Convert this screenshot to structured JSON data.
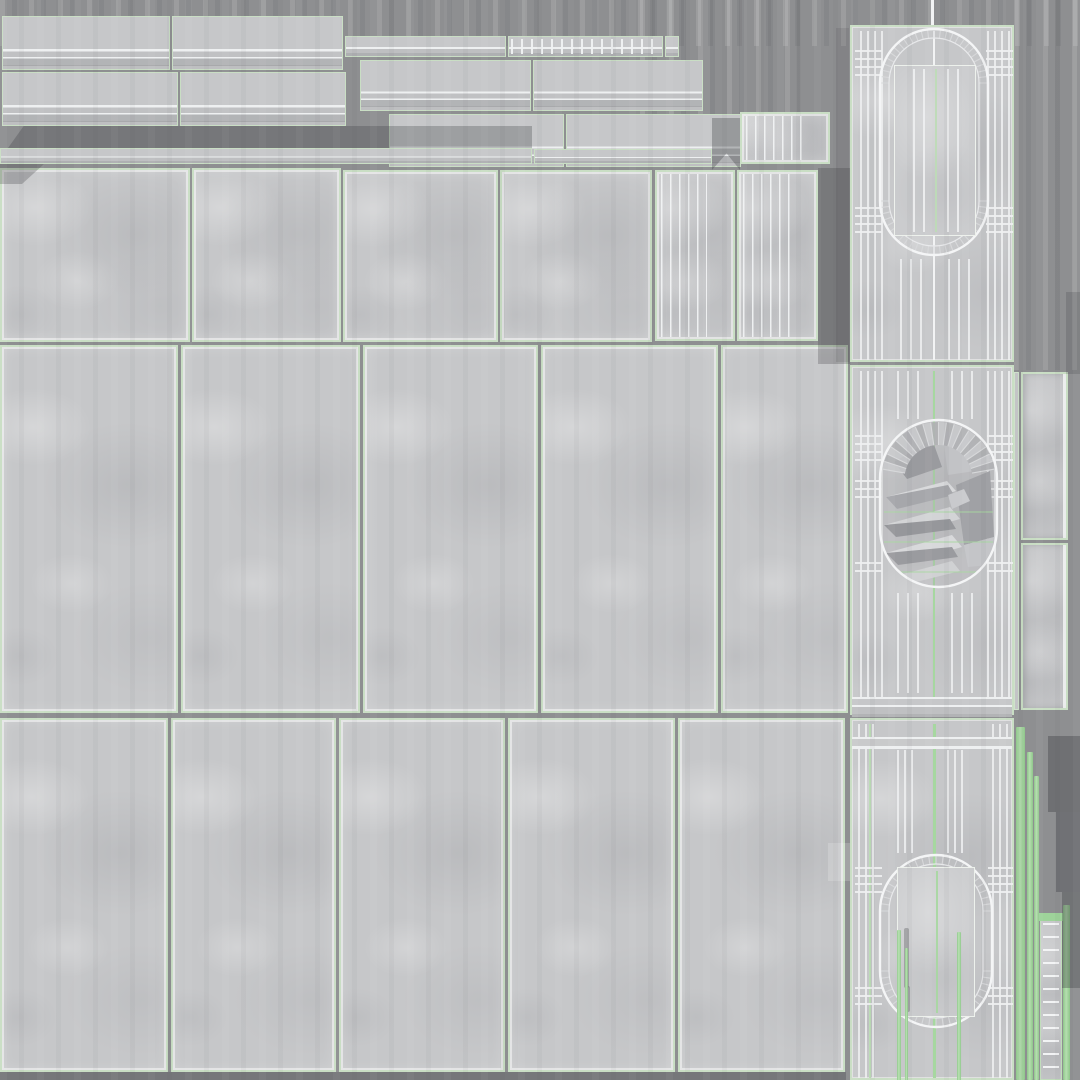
{
  "meta": {
    "description": "Texture atlas (UV sheet) for a concrete wall-panel 3D asset: baseboard molding strips, plain concrete tiles, fluted pilaster panels, three arched-niche panels, and bright green UV seam highlight stripes on a gray background.",
    "canvas": {
      "width": 1080,
      "height": 1080
    },
    "regions": [
      {
        "label": "molding-strips",
        "count": 8
      },
      {
        "label": "thin-cap-strips",
        "count": 5
      },
      {
        "label": "upper-tile-row",
        "count": 4
      },
      {
        "label": "fluted-pilaster-panels",
        "count": 3
      },
      {
        "label": "main-tile-grid-row-2",
        "count": 5
      },
      {
        "label": "main-tile-grid-row-3",
        "count": 5
      },
      {
        "label": "arched-niche-panels",
        "count": 3
      },
      {
        "label": "side-strips",
        "count": 3
      },
      {
        "label": "seam-highlight-stripes",
        "count": 4
      },
      {
        "label": "ladder-strip",
        "count": 1
      }
    ]
  },
  "palette": {
    "background": "#8e8f91",
    "concrete": "#c6c7c9",
    "concrete_light": "#d4d5d7",
    "concrete_dark": "#b6b7ba",
    "seam": "#c9dec4",
    "seam_light": "#e4efe0",
    "line": "#eef0f1",
    "line_soft": "#dcdee0",
    "green": "#a6d7a0",
    "green_soft": "#bcdcb6",
    "shadow": "#404246"
  },
  "atlas": {
    "streaks": [
      {
        "x": 0,
        "y": 0,
        "w": 1080,
        "h": 46
      },
      {
        "x": 640,
        "y": 0,
        "w": 160,
        "h": 125
      },
      {
        "x": 1014,
        "y": 0,
        "w": 66,
        "h": 370
      }
    ],
    "moldings": [
      {
        "x": 2,
        "y": 16,
        "w": 168,
        "h": 54
      },
      {
        "x": 172,
        "y": 16,
        "w": 171,
        "h": 54
      },
      {
        "x": 360,
        "y": 60,
        "w": 171,
        "h": 51
      },
      {
        "x": 533,
        "y": 60,
        "w": 170,
        "h": 51
      },
      {
        "x": 2,
        "y": 72,
        "w": 176,
        "h": 54
      },
      {
        "x": 180,
        "y": 72,
        "w": 166,
        "h": 54
      },
      {
        "x": 389,
        "y": 114,
        "w": 175,
        "h": 53
      },
      {
        "x": 566,
        "y": 114,
        "w": 175,
        "h": 53
      }
    ],
    "thins": [
      {
        "x": 345,
        "y": 36,
        "w": 161,
        "h": 21
      },
      {
        "x": 508,
        "y": 36,
        "w": 155,
        "h": 21,
        "ticks": true
      },
      {
        "x": 665,
        "y": 36,
        "w": 14,
        "h": 21
      },
      {
        "x": 0,
        "y": 148,
        "w": 532,
        "h": 16
      },
      {
        "x": 534,
        "y": 149,
        "w": 178,
        "h": 15
      }
    ],
    "tilesRow1": [
      {
        "x": 0,
        "y": 168,
        "w": 190,
        "h": 174
      },
      {
        "x": 192,
        "y": 168,
        "w": 149,
        "h": 174
      },
      {
        "x": 343,
        "y": 170,
        "w": 155,
        "h": 172
      },
      {
        "x": 500,
        "y": 170,
        "w": 152,
        "h": 172
      }
    ],
    "fluted": [
      {
        "x": 740,
        "y": 112,
        "w": 90,
        "h": 52,
        "fw": "70%"
      },
      {
        "x": 655,
        "y": 170,
        "w": 80,
        "h": 171,
        "fw": "60%"
      },
      {
        "x": 737,
        "y": 170,
        "w": 81,
        "h": 171,
        "fw": "68%"
      }
    ],
    "gridRow2": [
      {
        "x": 0,
        "y": 345,
        "w": 178,
        "h": 368
      },
      {
        "x": 181,
        "y": 345,
        "w": 179,
        "h": 368
      },
      {
        "x": 363,
        "y": 345,
        "w": 175,
        "h": 368
      },
      {
        "x": 541,
        "y": 345,
        "w": 177,
        "h": 368
      },
      {
        "x": 721,
        "y": 345,
        "w": 127,
        "h": 368
      }
    ],
    "gridRow3": [
      {
        "x": 0,
        "y": 718,
        "w": 168,
        "h": 354
      },
      {
        "x": 171,
        "y": 718,
        "w": 165,
        "h": 354
      },
      {
        "x": 339,
        "y": 718,
        "w": 166,
        "h": 354
      },
      {
        "x": 508,
        "y": 718,
        "w": 167,
        "h": 354
      },
      {
        "x": 678,
        "y": 718,
        "w": 167,
        "h": 354
      }
    ],
    "sideStrips": [
      {
        "x": 1021,
        "y": 372,
        "w": 47,
        "h": 168
      },
      {
        "x": 1021,
        "y": 543,
        "w": 47,
        "h": 167
      }
    ],
    "slivers": [
      {
        "x": 1014,
        "y": 372,
        "w": 5,
        "h": 338
      }
    ],
    "greenStripes": [
      {
        "x": 1016,
        "y": 727,
        "w": 9,
        "h": 353
      },
      {
        "x": 1027,
        "y": 752,
        "w": 6,
        "h": 328
      },
      {
        "x": 1034,
        "y": 776,
        "w": 5,
        "h": 304
      },
      {
        "x": 1063,
        "y": 905,
        "w": 7,
        "h": 175
      }
    ],
    "ladder": {
      "x": 1040,
      "y": 920,
      "w": 22,
      "h": 160
    },
    "whites": [
      {
        "x": 931,
        "y": 0,
        "w": 3,
        "h": 26
      }
    ],
    "lightPatches": [
      {
        "x": 828,
        "y": 843,
        "w": 22,
        "h": 38
      }
    ],
    "shadows": [
      {
        "x": 8,
        "y": 126,
        "w": 524,
        "h": 22,
        "a": 0.3,
        "clip": "polygon(3% 0,100% 0,100% 100%,0 100%)"
      },
      {
        "x": 0,
        "y": 164,
        "w": 44,
        "h": 20,
        "a": 0.28,
        "clip": "polygon(0 0,100% 0,50% 100%,0 100%)"
      },
      {
        "x": 712,
        "y": 118,
        "w": 28,
        "h": 52,
        "a": 0.34,
        "clip": "polygon(0 0,100% 0,100% 100%,52% 68%,0 100%)"
      },
      {
        "x": 818,
        "y": 168,
        "w": 32,
        "h": 196,
        "a": 0.28
      },
      {
        "x": 836,
        "y": 28,
        "w": 13,
        "h": 334,
        "a": 0.14
      },
      {
        "x": 0,
        "y": 1072,
        "w": 846,
        "h": 8,
        "a": 0.3
      },
      {
        "x": 1048,
        "y": 736,
        "w": 32,
        "h": 76,
        "a": 0.4
      },
      {
        "x": 1056,
        "y": 812,
        "w": 24,
        "h": 80,
        "a": 0.38
      },
      {
        "x": 1062,
        "y": 892,
        "w": 18,
        "h": 96,
        "a": 0.36
      },
      {
        "x": 1066,
        "y": 292,
        "w": 14,
        "h": 82,
        "a": 0.22
      }
    ],
    "archPanels": [
      {
        "name": "top",
        "x": 850,
        "y": 25,
        "w": 164,
        "h": 337,
        "oval": {
          "x": 28,
          "y": 2,
          "w": 108,
          "h": 226,
          "inner": 9
        },
        "fans": [
          {
            "cx": 82,
            "cy": 56,
            "r1": 45,
            "r2": 53.5,
            "a0": 180,
            "a1": 360,
            "n": 26
          },
          {
            "cx": 82,
            "cy": 174,
            "r1": 45,
            "r2": 53.5,
            "a0": 0,
            "a1": 180,
            "n": 26
          }
        ],
        "vlines": [
          {
            "x": 8
          },
          {
            "x": 15
          },
          {
            "x": 22
          },
          {
            "x": 29
          },
          {
            "x": 135
          },
          {
            "x": 142
          },
          {
            "x": 149
          },
          {
            "x": 156
          },
          {
            "x": 81,
            "w": 2,
            "c": "#f2f3f4",
            "o": 1
          },
          {
            "x": 48,
            "y1": 232
          },
          {
            "x": 58,
            "y1": 232
          },
          {
            "x": 68,
            "y1": 232
          },
          {
            "x": 96,
            "y1": 232
          },
          {
            "x": 106,
            "y1": 232
          },
          {
            "x": 116,
            "y1": 232
          }
        ],
        "hlines": [
          23,
          31,
          39,
          47,
          180,
          188,
          196,
          204
        ],
        "hspan": {
          "lx1": 3,
          "lx2": 30,
          "rx1": 134,
          "rx2": 161
        },
        "innerRect": {
          "x": 42,
          "y": 38,
          "w": 80,
          "h": 169,
          "vlines": [
            {
              "x": 18
            },
            {
              "x": 28
            },
            {
              "x": 52
            },
            {
              "x": 62
            },
            {
              "x": 40,
              "c": "#bcdcb6",
              "w": 2
            }
          ]
        }
      },
      {
        "name": "middle",
        "x": 850,
        "y": 365,
        "w": 164,
        "h": 350,
        "oval": {
          "x": 28,
          "y": 53,
          "w": 117,
          "h": 167,
          "inner": 0,
          "tint": 0.28
        },
        "fans": [
          {
            "cx": 86.5,
            "cy": 112,
            "r1": 34,
            "r2": 57,
            "a0": 190,
            "a1": 350,
            "n": 20,
            "fill": true
          }
        ],
        "facets": [
          {
            "p": "42,95 80,72 90,100 55,112",
            "c": "#9a9b9f"
          },
          {
            "p": "90,62 122,74 136,102 96,108",
            "c": "#c2c3c6"
          },
          {
            "p": "34,130 95,114 104,124 45,142",
            "c": "#d8d9db"
          },
          {
            "p": "34,130 45,142 102,128 96,118",
            "c": "#a6a7ab"
          },
          {
            "p": "32,158 98,140 108,152 44,170",
            "c": "#d3d4d6"
          },
          {
            "p": "32,158 44,170 104,162 98,152",
            "c": "#96979b"
          },
          {
            "p": "34,186 100,168 110,180 46,198",
            "c": "#d8d9db"
          },
          {
            "p": "34,186 46,198 106,190 100,180",
            "c": "#9a9b9f"
          },
          {
            "p": "40,210 100,194 108,204 52,218",
            "c": "#d0d1d3"
          },
          {
            "p": "104,118 138,104 142,170 112,178",
            "c": "#a0a1a5"
          },
          {
            "p": "112,178 142,170 138,198 116,200",
            "c": "#c4c5c8"
          },
          {
            "p": "96,128 112,122 118,134 100,142",
            "c": "#c9cacd"
          }
        ],
        "greenSvgLines": [
          145,
          175,
          205
        ],
        "vlines": [
          {
            "x": 8
          },
          {
            "x": 15
          },
          {
            "x": 22
          },
          {
            "x": 29
          },
          {
            "x": 135
          },
          {
            "x": 142
          },
          {
            "x": 149
          },
          {
            "x": 156
          },
          {
            "x": 81,
            "w": 2,
            "c": "#a6d7a0",
            "o": 1
          },
          {
            "x": 45,
            "y1": 4,
            "y2": 52
          },
          {
            "x": 55,
            "y1": 4,
            "y2": 52
          },
          {
            "x": 65,
            "y1": 4,
            "y2": 52
          },
          {
            "x": 99,
            "y1": 4,
            "y2": 52
          },
          {
            "x": 109,
            "y1": 4,
            "y2": 52
          },
          {
            "x": 119,
            "y1": 4,
            "y2": 52
          },
          {
            "x": 45,
            "y1": 226,
            "y2": 326
          },
          {
            "x": 55,
            "y1": 226,
            "y2": 326
          },
          {
            "x": 65,
            "y1": 226,
            "y2": 326
          },
          {
            "x": 99,
            "y1": 226,
            "y2": 326
          },
          {
            "x": 109,
            "y1": 226,
            "y2": 326
          },
          {
            "x": 119,
            "y1": 226,
            "y2": 326
          }
        ],
        "hlines": [
          68,
          76,
          84,
          92,
          113,
          121,
          129,
          195,
          203
        ],
        "hspan": {
          "lx1": 3,
          "lx2": 30,
          "rx1": 135,
          "rx2": 161
        },
        "railBottom": {
          "y": 330,
          "h": 20
        }
      },
      {
        "name": "bottom",
        "x": 850,
        "y": 718,
        "w": 164,
        "h": 362,
        "oval": {
          "x": 28,
          "y": 135,
          "w": 112,
          "h": 172,
          "inner": 9
        },
        "fans": [
          {
            "cx": 84,
            "cy": 191,
            "r1": 47,
            "r2": 55,
            "a0": 180,
            "a1": 360,
            "n": 24
          },
          {
            "cx": 84,
            "cy": 251,
            "r1": 47,
            "r2": 55,
            "a0": 0,
            "a1": 180,
            "n": 24
          }
        ],
        "vlines": [
          {
            "x": 6
          },
          {
            "x": 13
          },
          {
            "x": 20
          },
          {
            "x": 140
          },
          {
            "x": 147
          },
          {
            "x": 154
          },
          {
            "x": 17,
            "w": 2,
            "c": "#bcdcb6",
            "o": 1
          },
          {
            "x": 81,
            "w": 3,
            "c": "#a6d7a0",
            "o": 1
          },
          {
            "x": 45,
            "y1": 30,
            "y2": 133
          },
          {
            "x": 52,
            "y1": 30,
            "y2": 133
          },
          {
            "x": 59,
            "y1": 30,
            "y2": 133
          },
          {
            "x": 95,
            "y1": 30,
            "y2": 133
          },
          {
            "x": 102,
            "y1": 30,
            "y2": 133
          },
          {
            "x": 109,
            "y1": 30,
            "y2": 133
          }
        ],
        "hlines": [
          147,
          155,
          163,
          171,
          267,
          275,
          283
        ],
        "hspan": {
          "lx1": 3,
          "lx2": 30,
          "rx1": 136,
          "rx2": 161
        },
        "railTop": {
          "y": 17,
          "h": 12
        },
        "innerRect": {
          "x": 45,
          "y": 147,
          "w": 76,
          "h": 148,
          "vlines": [
            {
              "x": 38,
              "c": "#a6d7a0",
              "w": 2
            }
          ],
          "smudges": [
            {
              "x": 6,
              "y": 60,
              "w": 5,
              "h": 60
            },
            {
              "x": 8,
              "y": 118,
              "w": 4,
              "h": 26
            }
          ]
        },
        "extraGreens": [
          {
            "x": 45,
            "y": 210,
            "w": 4,
            "h": 152
          },
          {
            "x": 53,
            "y": 228,
            "w": 3,
            "h": 134
          },
          {
            "x": 105,
            "y": 212,
            "w": 4,
            "h": 150
          }
        ]
      }
    ]
  }
}
